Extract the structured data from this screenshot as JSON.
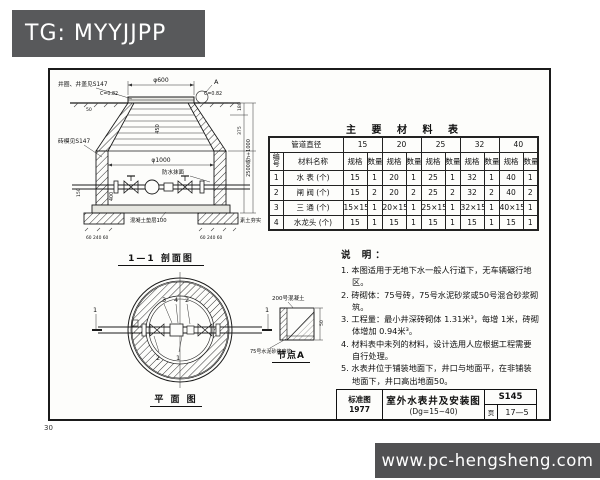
{
  "colors": {
    "tag_bg": "#58595b",
    "watermark_bg": "#48484a",
    "line": "#1b1b1b",
    "paper": "#fdfdfb"
  },
  "tag": {
    "text": "TG: MYYJJPP"
  },
  "watermark": {
    "text": "www.pc-hengsheng.com"
  },
  "page_number": "30",
  "section_view": {
    "caption": "1—1 剖面图",
    "labels": {
      "cover": "井圈、井盖见S147",
      "dia_top": "φ600",
      "detail_mark": "A",
      "slope": "C=0.82",
      "mould": "砖模见S147",
      "dia_inner": "φ1000",
      "dia_cone": "450",
      "pipe_dim": "400",
      "plaster": "防水抹面",
      "bedding": "混凝土垫层100",
      "earth": "素土夯实",
      "dim_180": "180",
      "dim_375": "375",
      "dim_total": "2500或h+1000",
      "dim_150": "150",
      "dim_50": "50",
      "dims_bottom": "60 240 60"
    }
  },
  "plan_view": {
    "caption": "平 面 图",
    "mark": "1",
    "callout_top": [
      "3",
      "4",
      "2"
    ],
    "callout_bottom": [
      "2",
      "1"
    ]
  },
  "detail_a": {
    "caption": "节点A",
    "label_top": "200号混凝土",
    "label_left": "75号水泥砂浆座浆",
    "dim_right": "50"
  },
  "materials_table": {
    "title": "主 要 材 料 表",
    "diameter_header": "管道直径",
    "diameters": [
      "15",
      "20",
      "25",
      "32",
      "40"
    ],
    "col_no": "编号",
    "col_name": "材料名称",
    "col_spec": "规格",
    "col_qty": "数量",
    "rows": [
      {
        "no": "1",
        "name": "水 表 (个)",
        "cells": [
          [
            "15",
            "1"
          ],
          [
            "20",
            "1"
          ],
          [
            "25",
            "1"
          ],
          [
            "32",
            "1"
          ],
          [
            "40",
            "1"
          ]
        ]
      },
      {
        "no": "2",
        "name": "闸 阀 (个)",
        "cells": [
          [
            "15",
            "2"
          ],
          [
            "20",
            "2"
          ],
          [
            "25",
            "2"
          ],
          [
            "32",
            "2"
          ],
          [
            "40",
            "2"
          ]
        ]
      },
      {
        "no": "3",
        "name": "三 通 (个)",
        "cells": [
          [
            "15×15",
            "1"
          ],
          [
            "20×15",
            "1"
          ],
          [
            "25×15",
            "1"
          ],
          [
            "32×15",
            "1"
          ],
          [
            "40×15",
            "1"
          ]
        ]
      },
      {
        "no": "4",
        "name": "水龙头 (个)",
        "cells": [
          [
            "15",
            "1"
          ],
          [
            "15",
            "1"
          ],
          [
            "15",
            "1"
          ],
          [
            "15",
            "1"
          ],
          [
            "15",
            "1"
          ]
        ]
      }
    ]
  },
  "notes": {
    "title": "说 明：",
    "items": [
      "1. 本图适用于无地下水一般人行道下，无车辆碾行地区。",
      "2. 砖砌体：75号砖，75号水泥砂浆或50号混合砂浆砌筑。",
      "3. 工程量：最小井深砖砌体 1.31米³，每增 1米，砖砌体增加 0.94米³。",
      "4. 材料表中未列的材料，设计选用人应根据工程需要自行处理。",
      "5. 水表井位于铺装地面下，井口与地面平，在非铺装地面下，井口高出地面50。"
    ]
  },
  "title_block": {
    "left_top": "标准图",
    "left_bottom": "1977",
    "title": "室外水表井及安装图",
    "subtitle": "(Dg=15~40)",
    "code": "S145",
    "page_label": "页",
    "page": "17—5"
  }
}
